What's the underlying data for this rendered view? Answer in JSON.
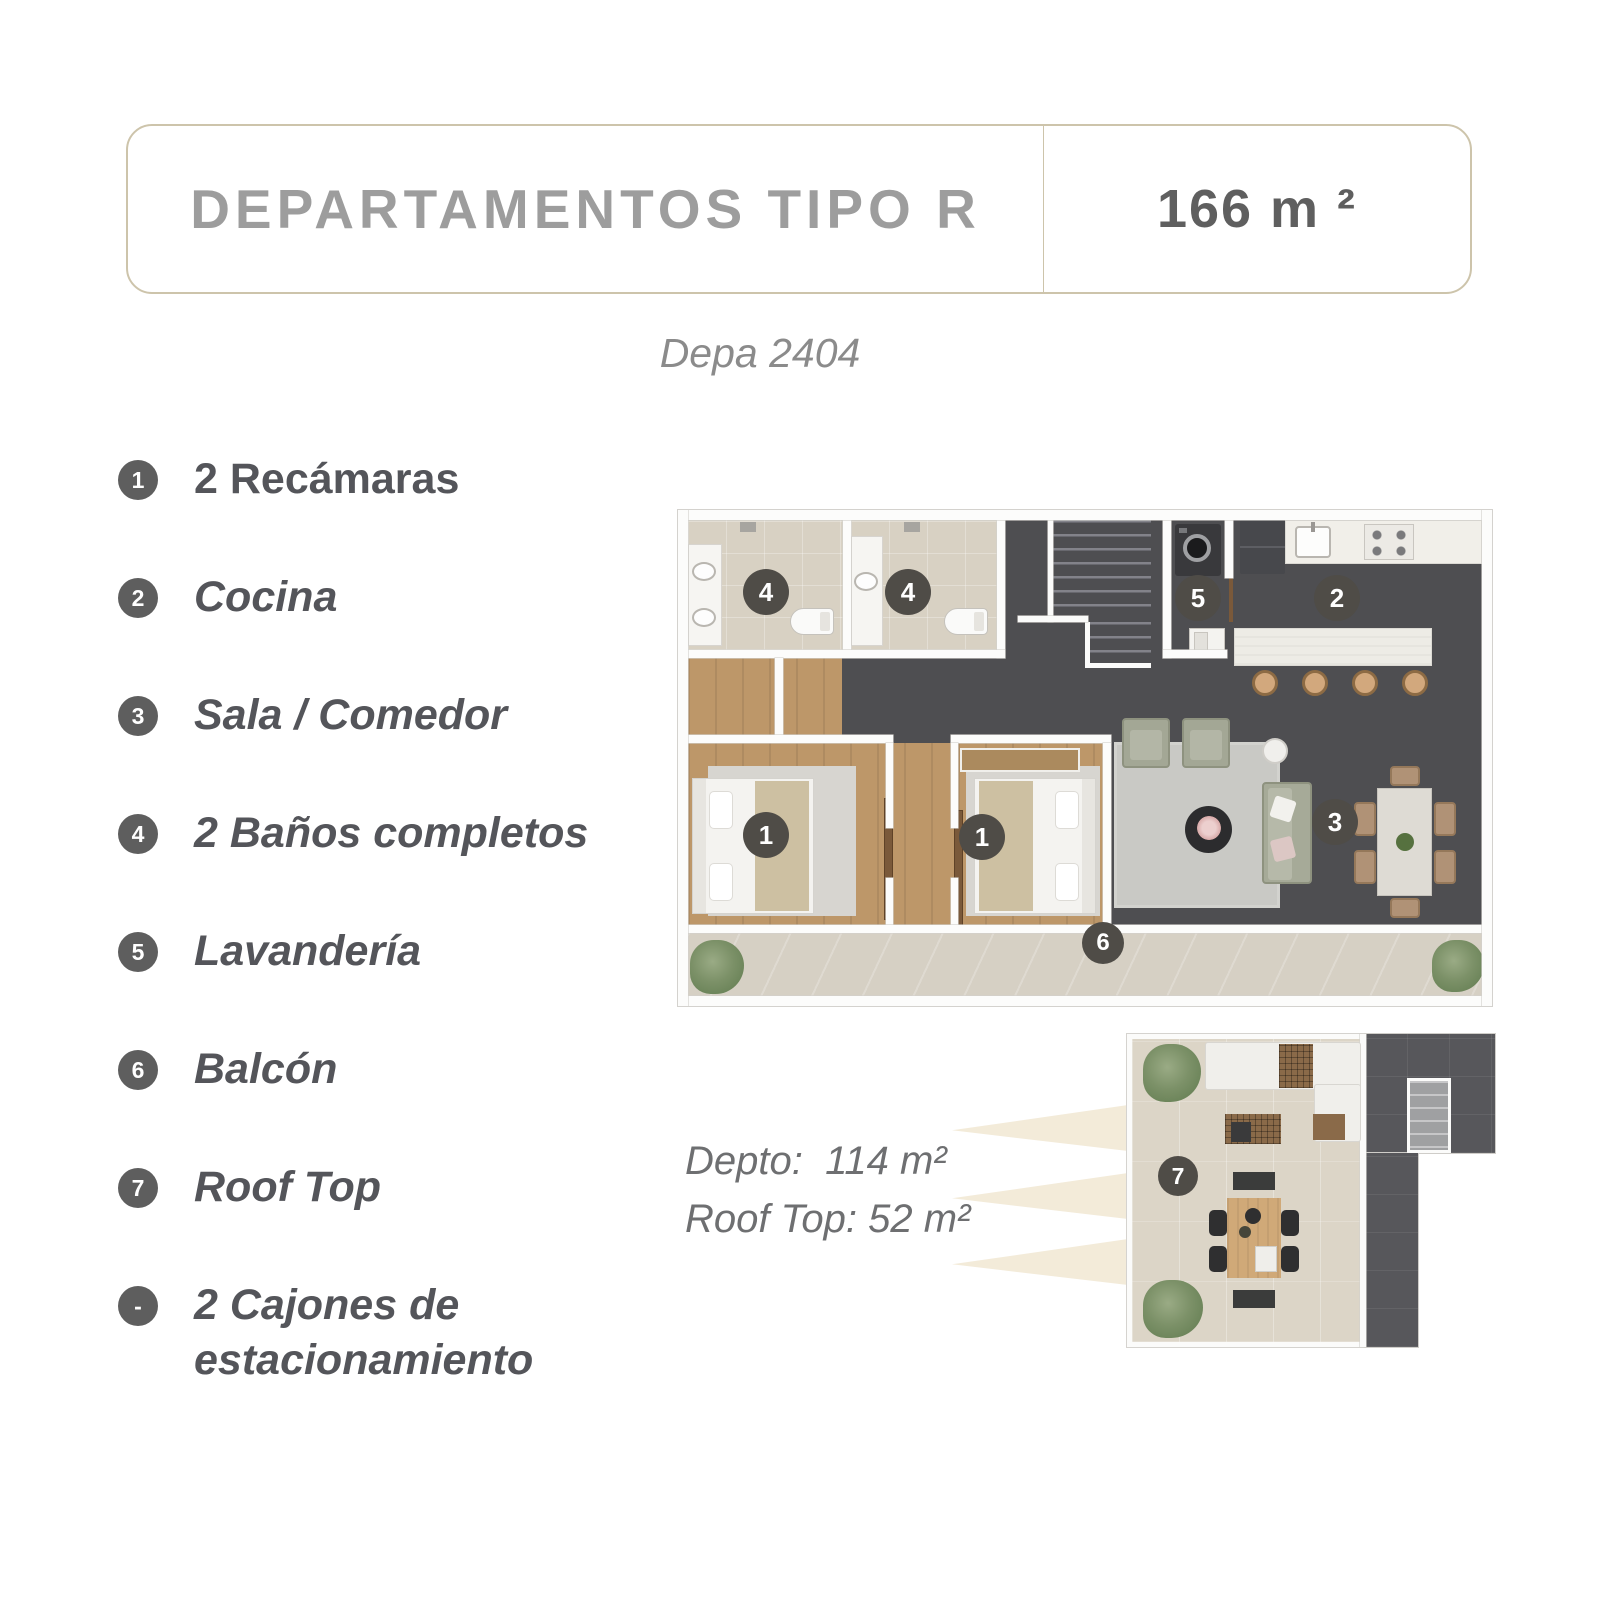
{
  "header": {
    "title": "DEPARTAMENTOS TIPO R",
    "area": "166 m ²"
  },
  "subtitle": "Depa 2404",
  "features": [
    {
      "num": "1",
      "label": "2 Recámaras"
    },
    {
      "num": "2",
      "label": "Cocina"
    },
    {
      "num": "3",
      "label": "Sala / Comedor"
    },
    {
      "num": "4",
      "label": "2 Baños completos"
    },
    {
      "num": "5",
      "label": "Lavandería"
    },
    {
      "num": "6",
      "label": "Balcón"
    },
    {
      "num": "7",
      "label": "Roof Top"
    },
    {
      "num": "-",
      "label": "2 Cajones de estacionamiento"
    }
  ],
  "floorplan": {
    "markers": {
      "bath1": "4",
      "bath2": "4",
      "laundry": "5",
      "kitchen": "2",
      "bedroom1": "1",
      "bedroom2": "1",
      "living": "3",
      "balcony": "6"
    }
  },
  "rooftop": {
    "marker": "7",
    "info_line1": "Depto:  114 m²",
    "info_line2": "Roof Top: 52 m²"
  },
  "colors": {
    "accent_border": "#cdc4ab",
    "title_text": "#9d9d9d",
    "area_text": "#5f5f5f",
    "feature_text": "#54555a",
    "badge_list": "#5e5e5e",
    "badge_plan": "#4f4c47",
    "floor_dark": "#4e4e51",
    "floor_wood": "#bd9769",
    "floor_tile": "#d8d1c3",
    "terrace_tile": "#dcd5c7",
    "ray": "#f3ebd9"
  }
}
